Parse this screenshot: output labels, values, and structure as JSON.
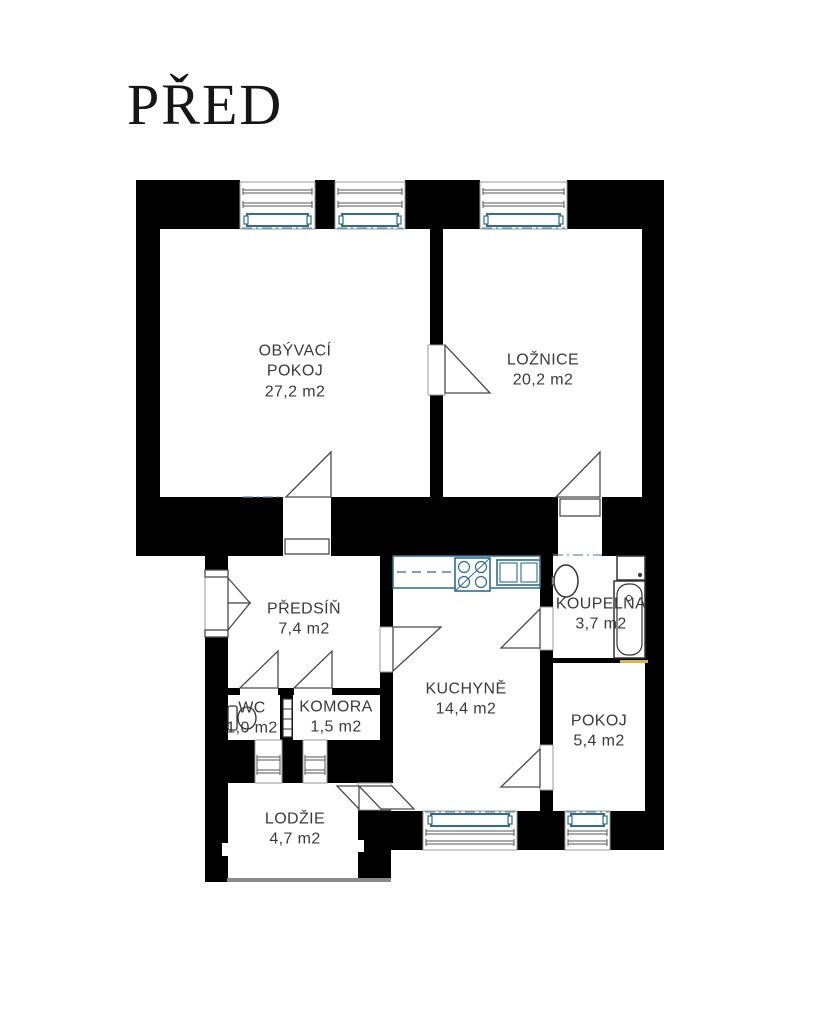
{
  "title": "PŘED",
  "floor_plan": {
    "rooms": [
      {
        "name": "OBÝVACÍ POKOJ",
        "area": "27,2 m2"
      },
      {
        "name": "LOŽNICE",
        "area": "20,2 m2"
      },
      {
        "name": "PŘEDSÍŇ",
        "area": "7,4 m2"
      },
      {
        "name": "KUCHYNĚ",
        "area": "14,4 m2"
      },
      {
        "name": "KOUPELNA",
        "area": "3,7 m2"
      },
      {
        "name": "WC",
        "area": "1,0 m2"
      },
      {
        "name": "KOMORA",
        "area": "1,5 m2"
      },
      {
        "name": "POKOJ",
        "area": "5,4 m2"
      },
      {
        "name": "LODŽIE",
        "area": "4,7 m2"
      }
    ],
    "colors": {
      "wall": "#000000",
      "line_gray": "#4a4a4a",
      "fixture_blue": "#2f6e8f",
      "dash_blue": "#6b93a8",
      "accent_yellow": "#d9b44a",
      "label_text": "#3b3b3b",
      "background": "#ffffff"
    }
  }
}
